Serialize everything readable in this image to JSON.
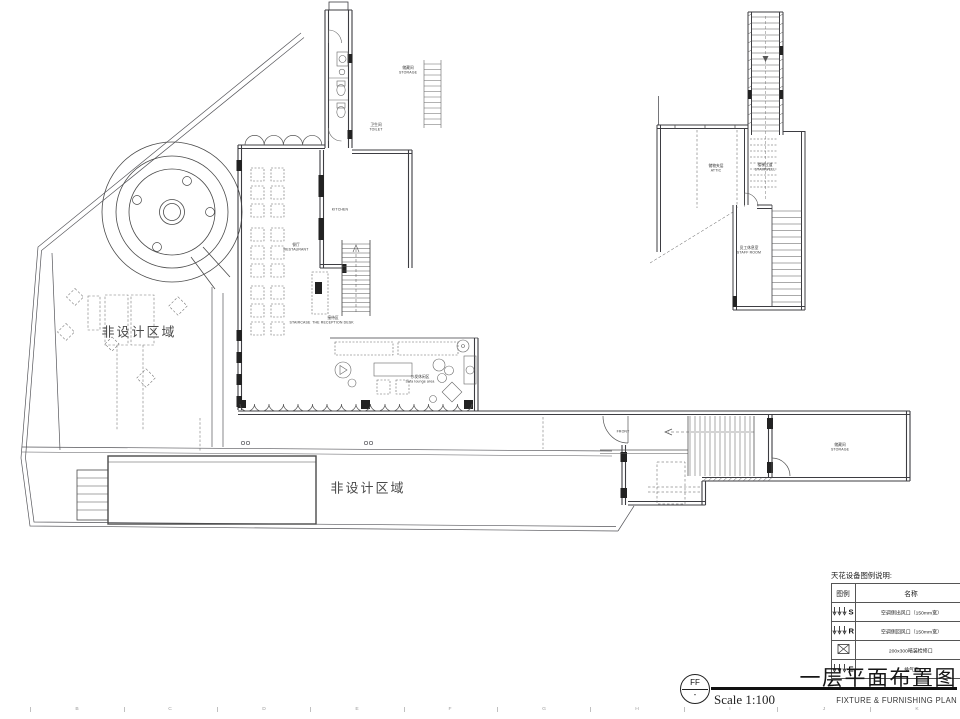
{
  "page": {
    "background": "#ffffff",
    "ink_color": "#4a4a4a"
  },
  "plan": {
    "area_labels": {
      "non_design_left": "非设计区域",
      "non_design_bottom": "非设计区域"
    },
    "labels": {
      "restaurant": {
        "cn": "餐厅",
        "en": "RESTAURANT"
      },
      "kitchen": {
        "en": "KITCHEN"
      },
      "reception": {
        "cn": "接待区",
        "en": "THE RECEPTION DESK"
      },
      "staircase": {
        "en": "STAIRCASE"
      },
      "sofa_lounge": {
        "cn": "沙发休闲区",
        "en": "Sofa lounge area"
      },
      "storage_top": {
        "cn": "储藏间",
        "en": "STORAGE"
      },
      "toilet": {
        "cn": "卫生间",
        "en": "TOILET"
      },
      "attic": {
        "cn": "储物夹层",
        "en": "ATTIC"
      },
      "stairwell": {
        "cn": "楼梯过道",
        "en": "STAIRWELL"
      },
      "staff_room": {
        "cn": "员工休息室",
        "en": "STAFF ROOM"
      },
      "storage_right": {
        "cn": "储藏间",
        "en": "STORAGE"
      },
      "front_door": {
        "en": "FRONT"
      }
    }
  },
  "legend": {
    "title": "天花设备图例说明:",
    "headers": [
      "图例",
      "名称"
    ],
    "rows": [
      {
        "symbol": "S",
        "name": "空调侧出风口（150mm宽）"
      },
      {
        "symbol": "R",
        "name": "空调侧回风口（150mm宽）"
      },
      {
        "symbol": "",
        "name": "200x300暗装检修口"
      },
      {
        "symbol": "E",
        "name": "排气扇"
      }
    ]
  },
  "title_block": {
    "tag_top": "FF",
    "tag_bottom": "-",
    "title_cn": "一层平面布置图",
    "scale": "Scale 1:100",
    "title_en": "FIXTURE & FURNISHING PLAN"
  },
  "ruler": {
    "letters": [
      "B",
      "C",
      "D",
      "E",
      "F",
      "G",
      "H",
      "I",
      "J",
      "K"
    ]
  }
}
